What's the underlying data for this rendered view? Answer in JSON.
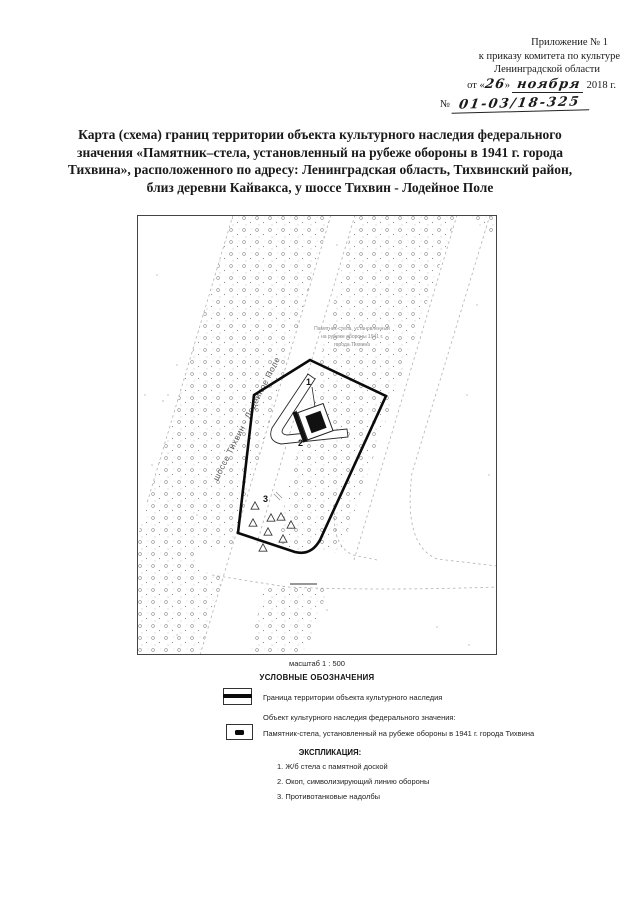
{
  "header": {
    "line1": "Приложение № 1",
    "line2": "к приказу комитета по культуре",
    "line3": "Ленинградской области",
    "date_prefix": "от «",
    "date_day": "26",
    "date_close": "»",
    "date_month": "ноября",
    "date_suffix": "2018 г.",
    "number_label": "№",
    "number_value": "01-03/18-325"
  },
  "title": {
    "lines": [
      "Карта (схема) границ территории объекта культурного наследия федерального",
      "значения «Памятник–стела, установленный на рубеже обороны в 1941 г. города",
      "Тихвина»,  расположенного по адресу: Ленинградская область, Тихвинский район,",
      "близ деревни Кайвакса,  у шоссе Тихвин - Лодейное Поле"
    ]
  },
  "map": {
    "road_label": "шоссе Тихвин - Лодейное Поле",
    "annotation_lines": [
      "Памятник-стела, установленный",
      "на рубеже обороны 1941 г.",
      "города Тихвина"
    ],
    "marker_1": "1",
    "marker_2": "2",
    "marker_3": "3"
  },
  "legend": {
    "scale": "масштаб 1 : 500",
    "heading": "УСЛОВНЫЕ ОБОЗНАЧЕНИЯ",
    "boundary_symbol": "box-with-thick-black-line",
    "boundary_label": "Граница территории объекта культурного наследия",
    "object_heading": "Объект культурного наследия федерального значения:",
    "object_symbol": "box-with-black-rect",
    "object_label": "Памятник-стела, установленный на рубеже обороны в 1941 г. города Тихвина",
    "explication_heading": "ЭКСПЛИКАЦИЯ:",
    "explication_items": [
      "1. Ж/б стела с памятной доской",
      "2. Окоп, символизирующий линию обороны",
      "3. Противотанковые надолбы"
    ]
  },
  "colors": {
    "ink": "#1a1a1a",
    "map_line_gray": "#b0b0b0"
  }
}
